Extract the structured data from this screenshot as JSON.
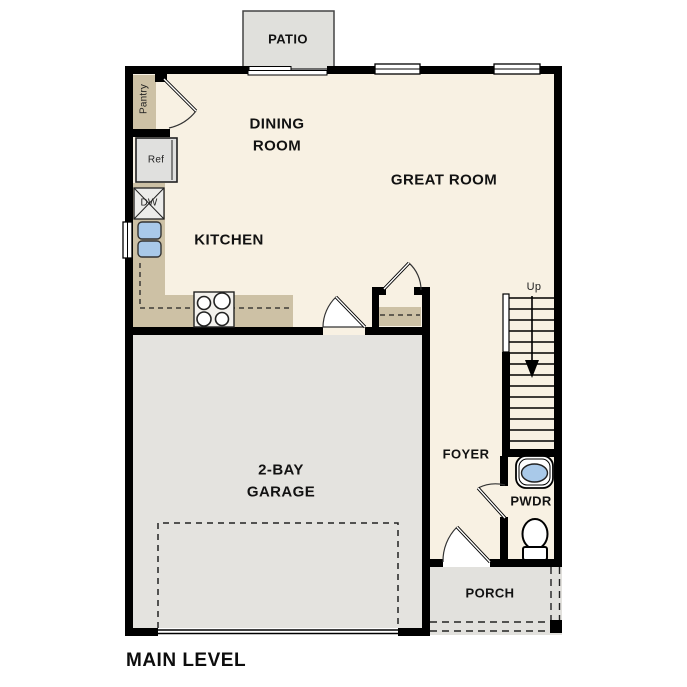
{
  "title": {
    "label": "MAIN LEVEL"
  },
  "colors": {
    "wall": "#000000",
    "floor": "#f8f1e3",
    "tan": "#cdc1a5",
    "garage": "#e4e3df",
    "patio": "#e0e0dc",
    "porch": "#e2e1dd",
    "appliance": "#e0e0de",
    "dw": "#ececea",
    "stove": "#f3f1ed",
    "sink": "#a9c9e9",
    "outline": "#1a1a1a"
  },
  "rooms": {
    "patio": "PATIO",
    "dining_line1": "DINING",
    "dining_line2": "ROOM",
    "great": "GREAT ROOM",
    "kitchen": "KITCHEN",
    "pantry": "Pantry",
    "garage_line1": "2-BAY",
    "garage_line2": "GARAGE",
    "foyer": "FOYER",
    "pwdr": "PWDR",
    "porch": "PORCH"
  },
  "fixtures": {
    "refrigerator": "Ref",
    "dishwasher": "DW",
    "stairs_direction": "Up"
  }
}
